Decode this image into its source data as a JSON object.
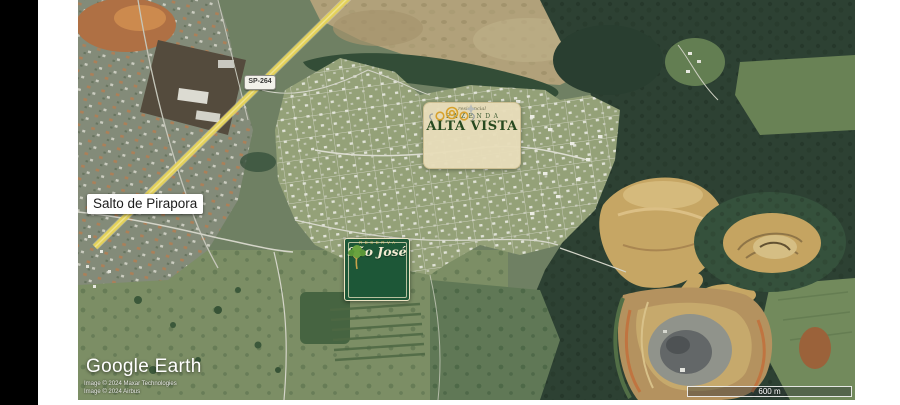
{
  "map": {
    "place_label": "Salto de Pirapora",
    "road_shield_label": "SP-264",
    "scale_label": "600 m"
  },
  "watermark": {
    "brand": "Google Earth",
    "attribution1": "Image © 2024 Maxar Technologies",
    "attribution2": "Image © 2024 Airbus"
  },
  "logos": {
    "alta_vista": {
      "pre_title": "residencial",
      "subtitle": "FAZENDA",
      "title": "ALTA VISTA",
      "colors": {
        "background": "#e7ddb9",
        "text": "#27491f",
        "gold": "#d8a22c"
      }
    },
    "sao_jose": {
      "pre_title": "RESERVA",
      "title": "São José",
      "colors": {
        "background": "#1d5737",
        "frame": "#ece4c2",
        "text": "#f2ecd2",
        "gold": "#d2b45a"
      }
    }
  },
  "scene_colors": {
    "field_green": "#6b7c5e",
    "forest_dark": "#24392b",
    "quarry_tan": "#c9a55f",
    "quarry_orange": "#c26f38",
    "highway_yellow": "#e8d355",
    "urban_gray": "#808876"
  }
}
